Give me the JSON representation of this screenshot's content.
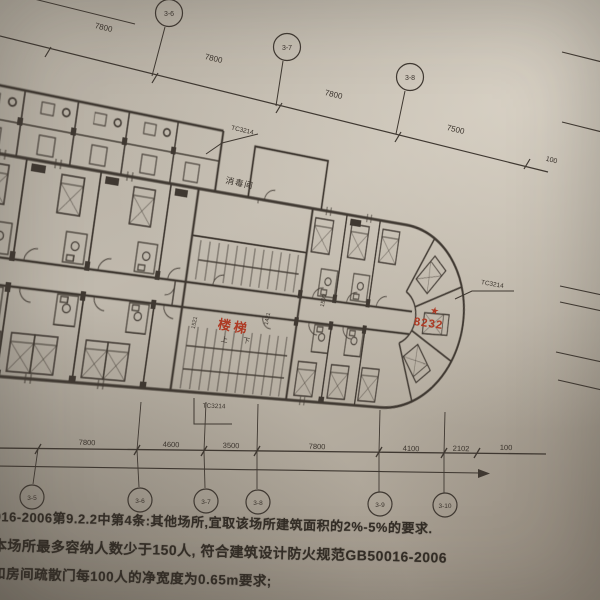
{
  "annotations": {
    "top_dims": [
      "7800",
      "7800",
      "7800",
      "7500",
      "100"
    ],
    "bottom_dims": [
      "7800",
      "4600",
      "3500",
      "7800",
      "4100",
      "2102",
      "100"
    ],
    "grid_labels_top": [
      "3-6",
      "3-7",
      "3-8"
    ],
    "grid_labels_bottom": [
      "3-5",
      "3-6",
      "3-7",
      "3-8",
      "3-9",
      "3-10"
    ],
    "window_tags": {
      "top": "TC3214",
      "right": "TC3214",
      "bottom": "TC3214"
    },
    "interior_dims": {
      "left": "1521",
      "mid": "1421",
      "right": "1500"
    },
    "labels": {
      "disinfection_room": "消毒间",
      "stairs": "楼梯",
      "up": "上",
      "down": "下"
    },
    "red_marks": {
      "room_number": "8232",
      "star": "★"
    },
    "notes": {
      "line1": "016-2006第9.2.2中第4条:其他场所,宜取该场所建筑面积的2%-5%的要求.",
      "line2": "本场所最多容纳人数少于150人, 符合建筑设计防火规范GB50016-2006",
      "line3": "和房间疏散门每100人的净宽度为0.65m要求;"
    },
    "colors": {
      "ink": "#3f3831",
      "red": "#ae3a24",
      "paper": "#b7b0a4"
    }
  }
}
